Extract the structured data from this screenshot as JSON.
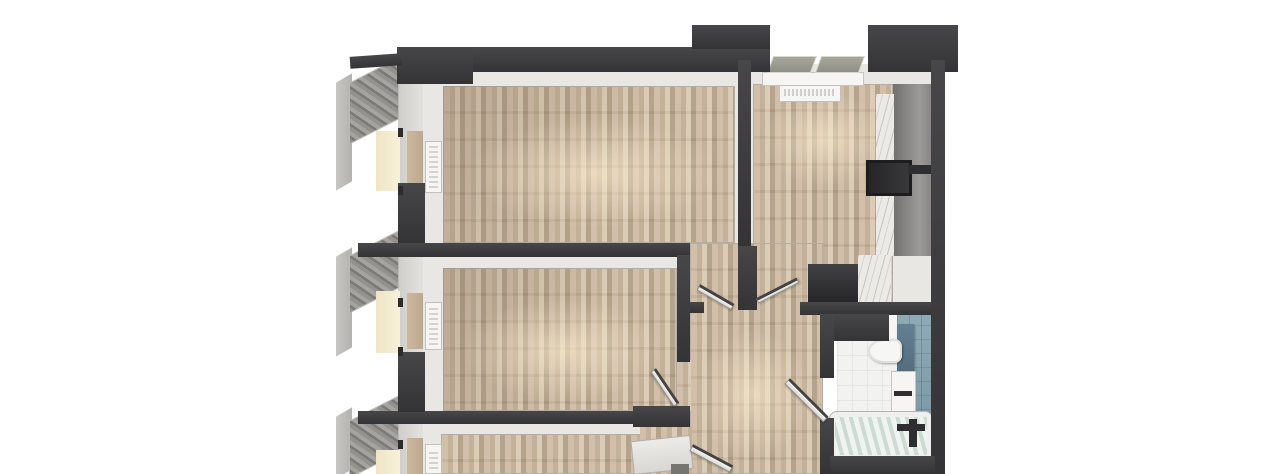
{
  "scene": {
    "kind": "apartment-floorplan-3d-render-top-view",
    "background": "#ffffff",
    "cropped_edges": "bottom"
  },
  "palette": {
    "wall_dark": "#343336",
    "wall_light": "#474649",
    "wood_a": "#cfbca6",
    "wood_b": "#c1ad94",
    "wood_c": "#d9c9b3",
    "wood_d": "#b19e86",
    "plaster": "#e9e7e4",
    "band": "#dedcd8",
    "fixture_white": "#f6f5f3",
    "fixture_dark": "#2e2d2f",
    "counter_a": "#73716f",
    "counter_b": "#9c9a98",
    "marble": "#eceae6",
    "tile_blue": "#7fa0ad",
    "bath_floor": "#f2f2f0",
    "water": "#dce6df",
    "cream_a": "#efe5c6",
    "cream_b": "#f8f1da",
    "tan_a": "#cbb89f"
  },
  "labels": {
    "render": "3D top-down apartment floor plan render",
    "bedroom_top": "room with wood floor (top-left)",
    "kitchen": "kitchen with wood floor (top-right)",
    "bedroom_middle": "room with wood floor (middle-left)",
    "bedroom_bottom": "room with wood floor (bottom-left, cropped)",
    "hallway": "hallway with wood floor",
    "bathroom": "bathroom with white tile floor and blue tiled wall",
    "balcony": "balcony glazing along left facade",
    "window": "open casement window",
    "window_sill": "window sill",
    "radiator": "radiator",
    "counter": "kitchen counter run",
    "marble_top": "marble countertop",
    "stove": "dark stove / oven unit",
    "island": "kitchen island unit",
    "toilet": "toilet",
    "cistern": "blue cistern shelf",
    "vanity": "washbasin vanity with faucet",
    "bathtub": "bathtub with water",
    "tub_faucet": "bath faucet",
    "door": "open interior door",
    "wall": "wall"
  }
}
